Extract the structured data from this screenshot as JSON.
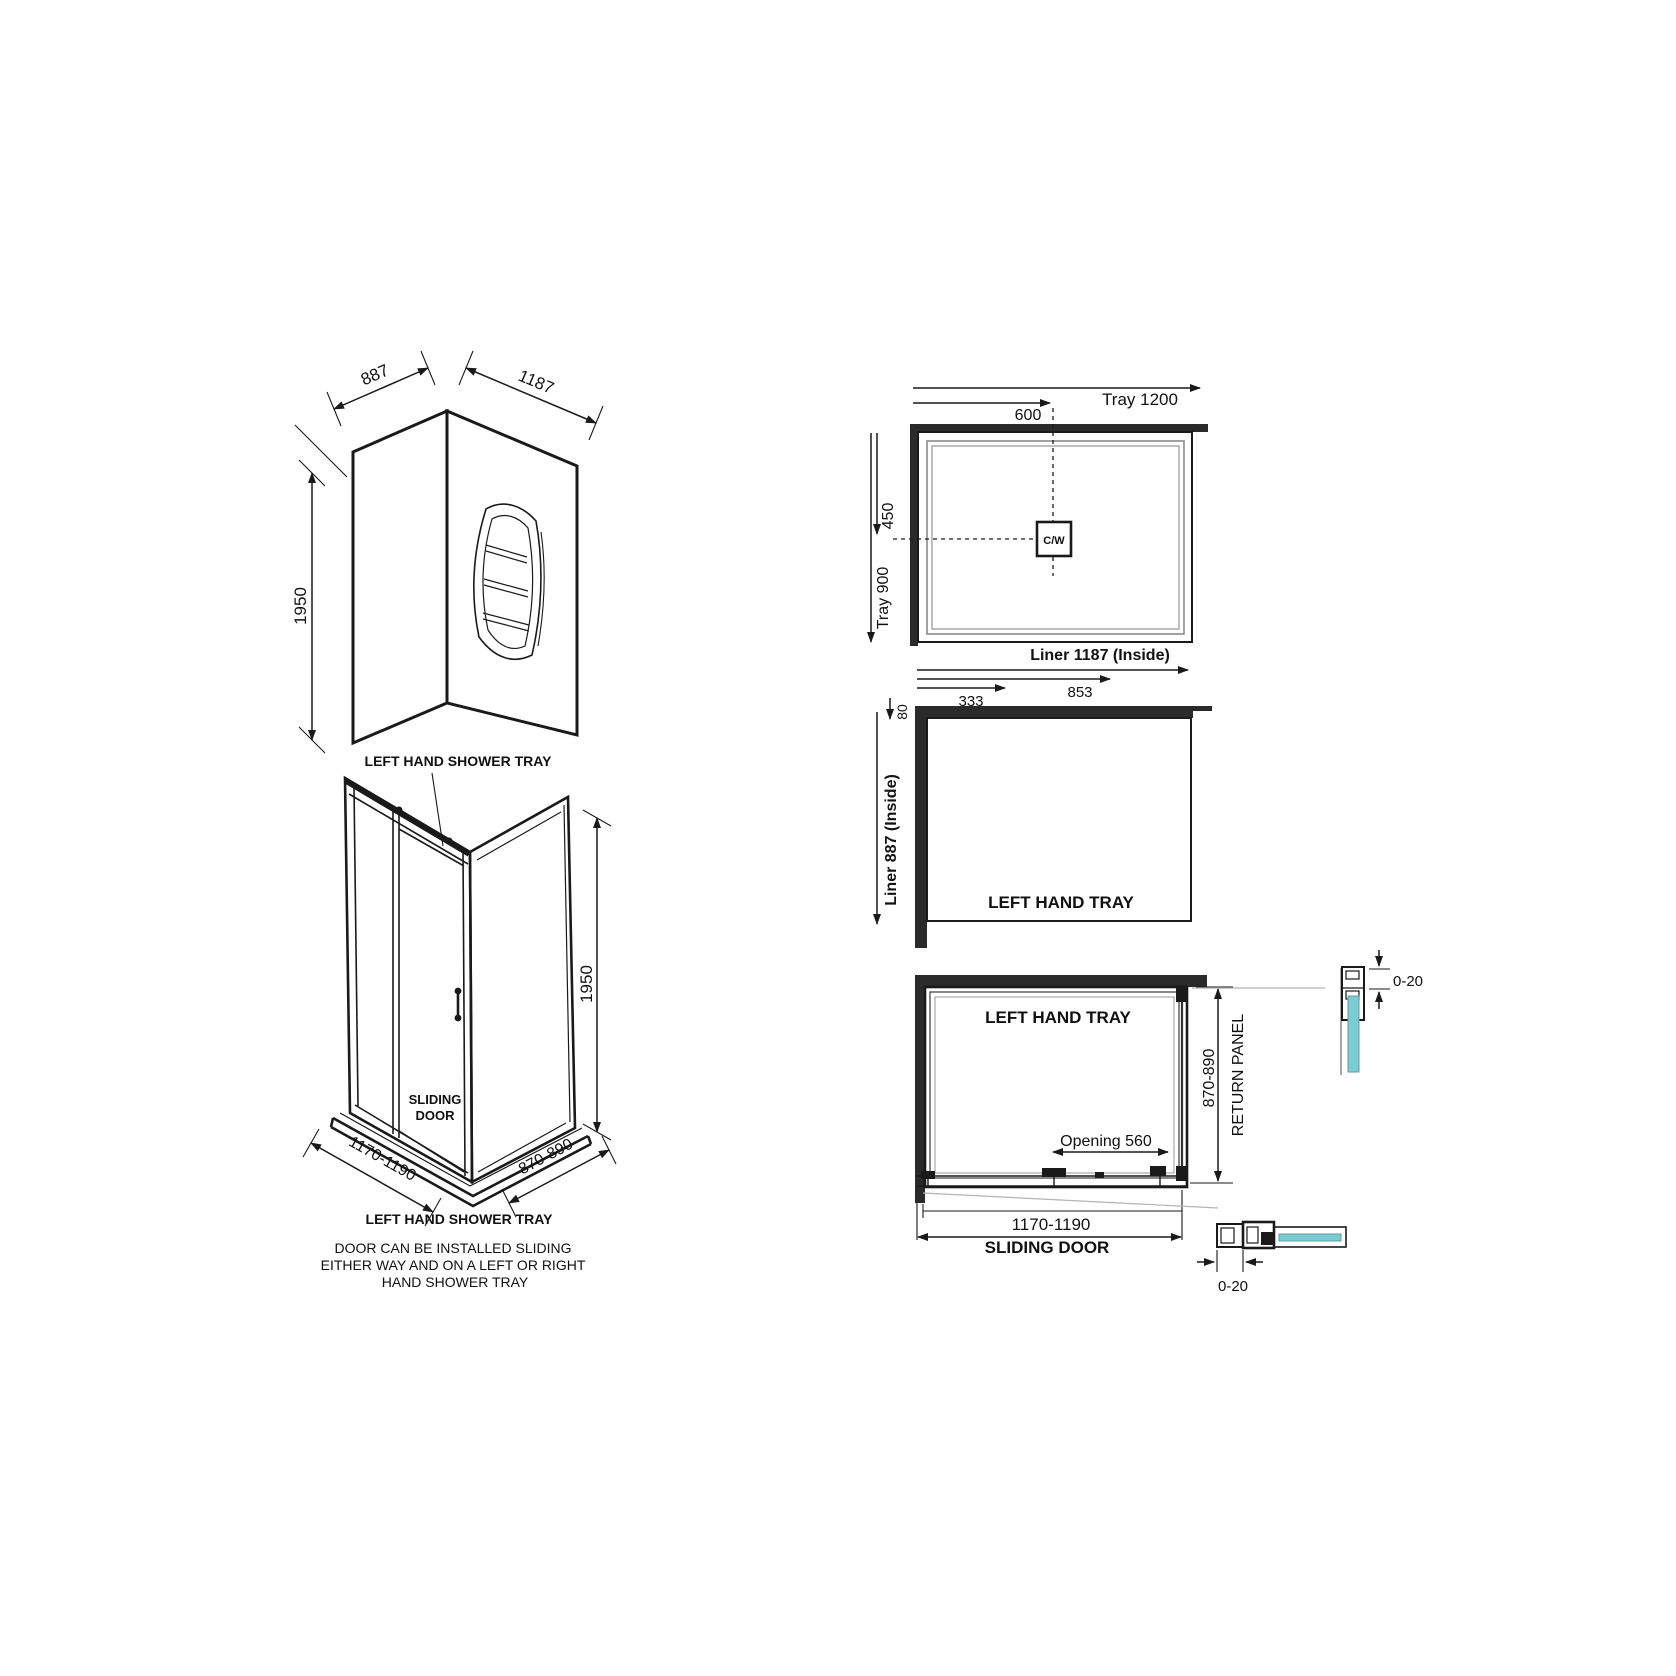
{
  "colors": {
    "line": "#1a1a1a",
    "wall_fill": "#2a2a2a",
    "glass_teal": "#7bccd1",
    "leader_gray": "#b3b3b3",
    "tray_rim_gray": "#8a8a8a",
    "background": "#ffffff"
  },
  "corner_walls": {
    "width_left": "887",
    "width_right": "1187",
    "height": "1950",
    "caption": "LEFT HAND SHOWER TRAY"
  },
  "enclosure_3d": {
    "door_line1": "SLIDING",
    "door_line2": "DOOR",
    "height": "1950",
    "width": "1170-1190",
    "depth": "870-890",
    "caption": "LEFT HAND SHOWER TRAY",
    "note1": "DOOR CAN BE INSTALLED SLIDING",
    "note2": "EITHER WAY AND ON A LEFT OR RIGHT",
    "note3": "HAND SHOWER TRAY"
  },
  "tray_plan": {
    "tray_width": "Tray 1200",
    "waste_x": "600",
    "waste_y": "450",
    "tray_depth": "Tray 900",
    "waste": "C/W",
    "liner_width": "Liner 1187 (Inside)"
  },
  "liner_plan": {
    "dim_a": "333",
    "dim_b": "853",
    "dim_c": "80",
    "liner_depth": "Liner 887 (Inside)",
    "label": "LEFT HAND TRAY"
  },
  "door_plan": {
    "label": "LEFT HAND TRAY",
    "opening": "Opening 560",
    "depth": "870-890",
    "return_panel": "RETURN PANEL",
    "width": "1170-1190",
    "door": "SLIDING DOOR"
  },
  "profile_details": {
    "top_adjust": "0-20",
    "bottom_adjust": "0-20"
  }
}
